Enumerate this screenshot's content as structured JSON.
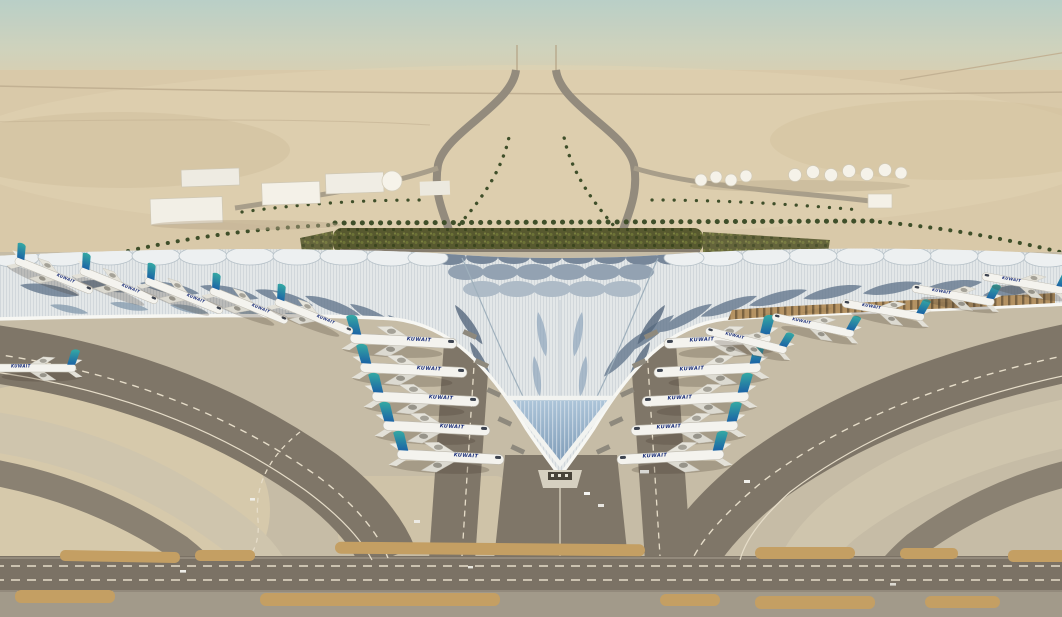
{
  "meta": {
    "title": "Aerial rendering of Kuwait International Airport new terminal in the desert",
    "type": "architectural-rendering"
  },
  "scene": {
    "aircraft": {
      "title": "KUWAIT",
      "parked_left_pier": 5,
      "parked_right_pier": 5,
      "parked_left_wing": 5,
      "parked_right_wing": 5,
      "taxiing": 1,
      "livery": {
        "fin_teal": "#35a9a4",
        "fin_blue": "#1c64a5",
        "fuselage": "#f4f3ee"
      }
    },
    "landmarks": {
      "terminal_roof": "Trefoil terminal with feathered blue solar-panel roof",
      "entrance": "Glazed V-shaped apex entrance with canopy",
      "garden": "Palm-lined green landscaped forecourt",
      "approach_roads": "Dual curved approach highway through desert",
      "warehouses": "White cargo / support buildings on west side",
      "fuel_tanks": "White fuel tank farm on east side",
      "airside": "Grey taxiways, aprons, dashed guide lines and sand islands"
    },
    "colors": {
      "sky_haze": "#b9cfc7",
      "desert": "#d9c9a9",
      "roof_light": "#e7eaeb",
      "roof_panel": "#64788e",
      "taxiway": "#7f7668",
      "apron": "#c6bca6",
      "island_sand": "#c49f63",
      "garden_green": "#57592f"
    }
  }
}
